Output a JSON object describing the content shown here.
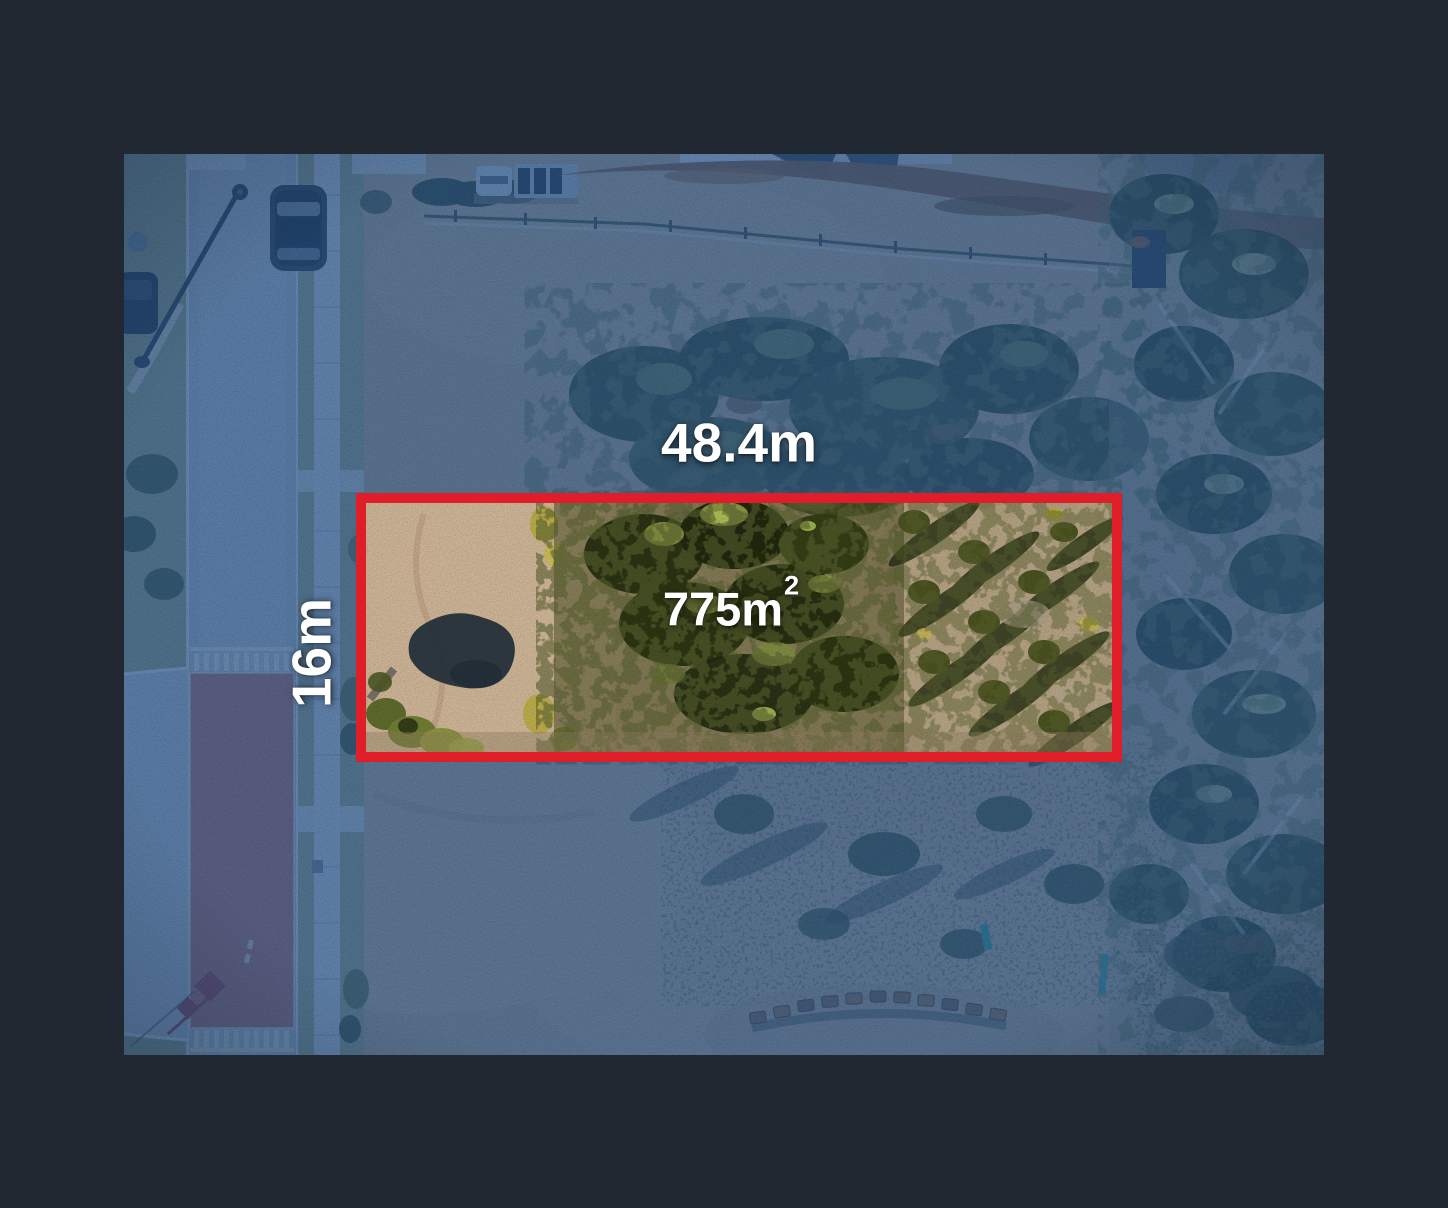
{
  "image_kind": "aerial-drone-photo-of-vacant-land-lot",
  "overlay": {
    "frontage_label": "48.4m",
    "depth_label": "16m",
    "area_value": "775m",
    "area_exponent": "2",
    "boundary_color": "#e01e2a",
    "label_color": "#ffffff"
  },
  "palette": {
    "frame_background": "#212831",
    "tinted_ground": "#5b7fa6",
    "tinted_street": "#6f92b6",
    "lot_dirt": "#c7ae92",
    "lot_scrub": "#2c3317",
    "red_asphalt_tinted": "#6d6b94"
  }
}
